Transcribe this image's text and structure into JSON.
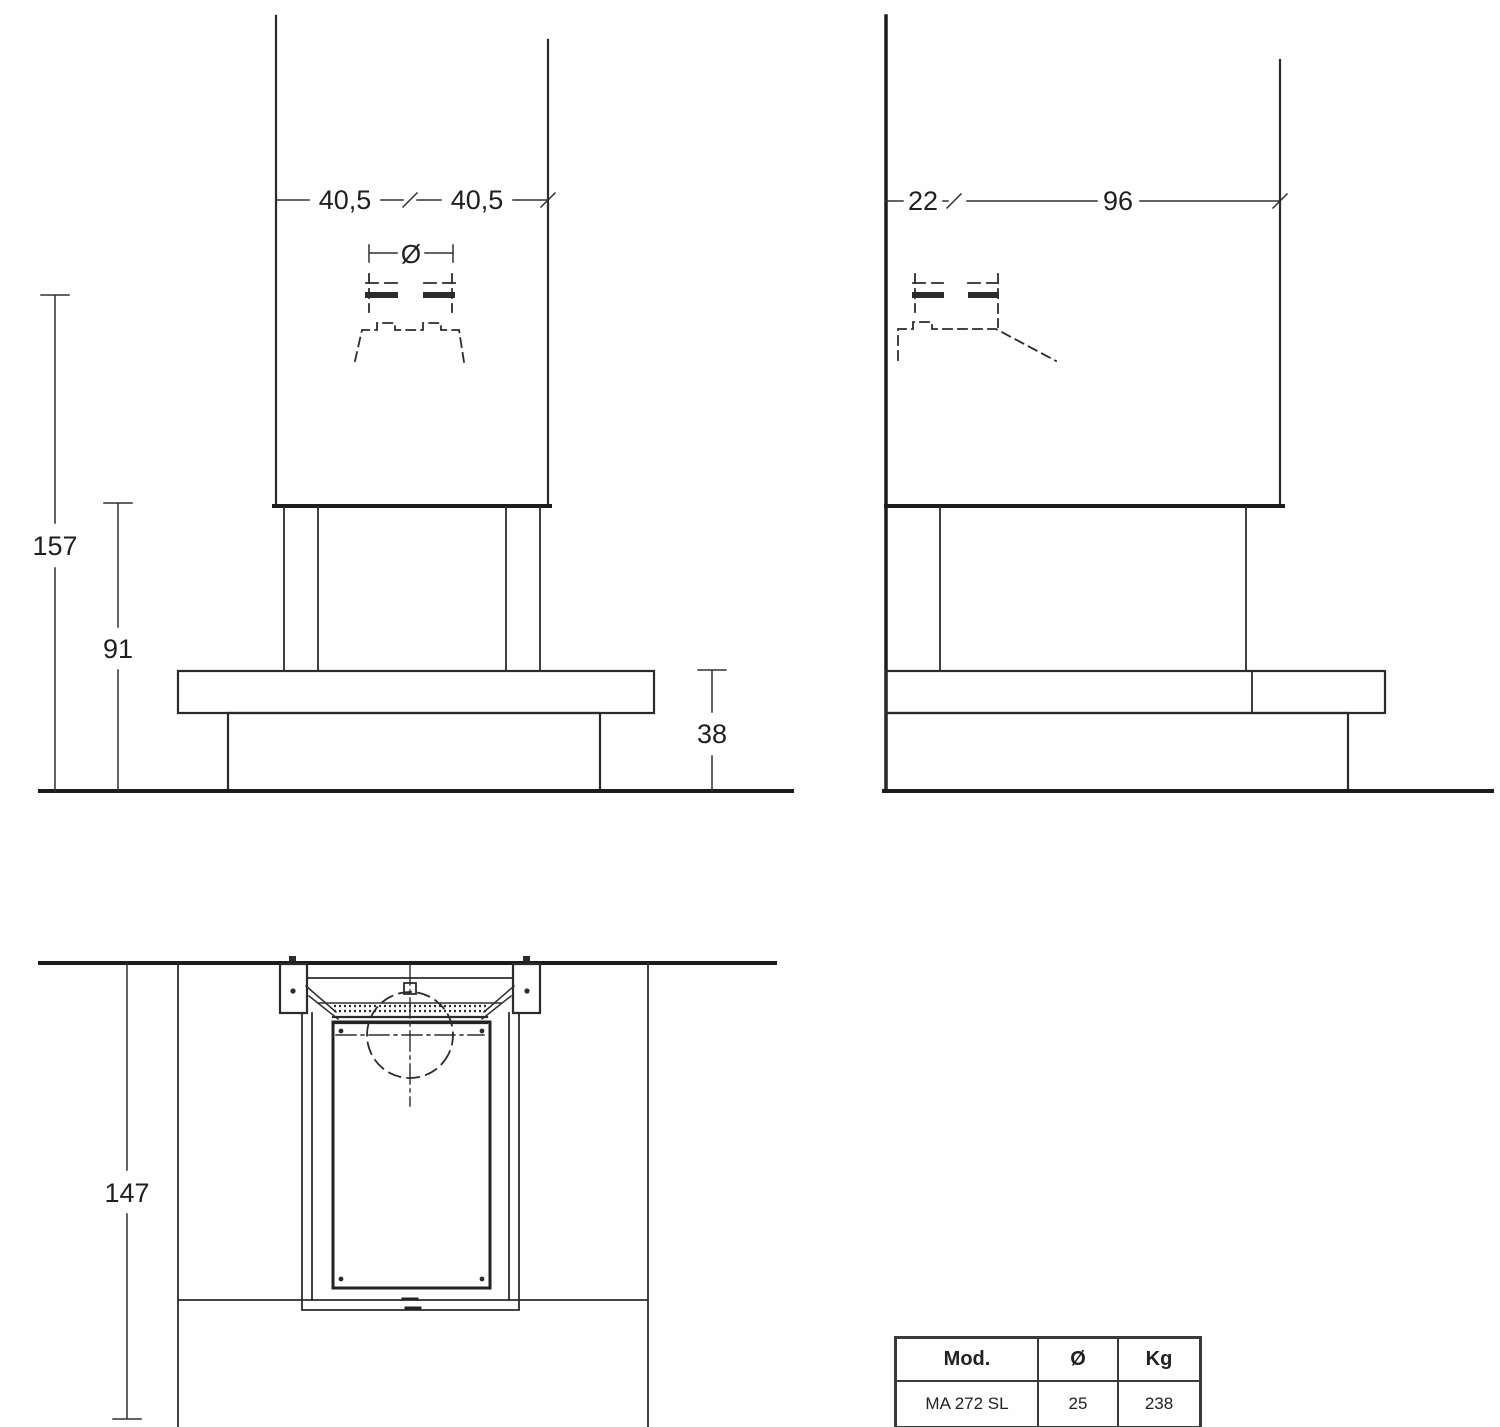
{
  "drawing_title": "fireplace-dimension-drawing",
  "front_view": {
    "dim_half_width_left": "40,5",
    "dim_half_width_right": "40,5",
    "flue_diameter_symbol": "Ø",
    "dim_total_height": "157",
    "dim_hood_height": "91",
    "dim_bench_height": "38"
  },
  "side_view": {
    "dim_wall_offset": "22",
    "dim_depth": "96"
  },
  "plan_view": {
    "dim_total_depth": "147"
  },
  "spec_table": {
    "headers": [
      "Mod.",
      "Ø",
      "Kg"
    ],
    "rows": [
      {
        "mod": "MA 272 SL",
        "diameter": "25",
        "kg": "238"
      }
    ]
  },
  "colors": {
    "ink": "#2b2b2b",
    "ink_heavy": "#1c1c1c",
    "background": "#fefefe",
    "table_border": "#3a3a3a",
    "text": "#1f1f1f"
  }
}
